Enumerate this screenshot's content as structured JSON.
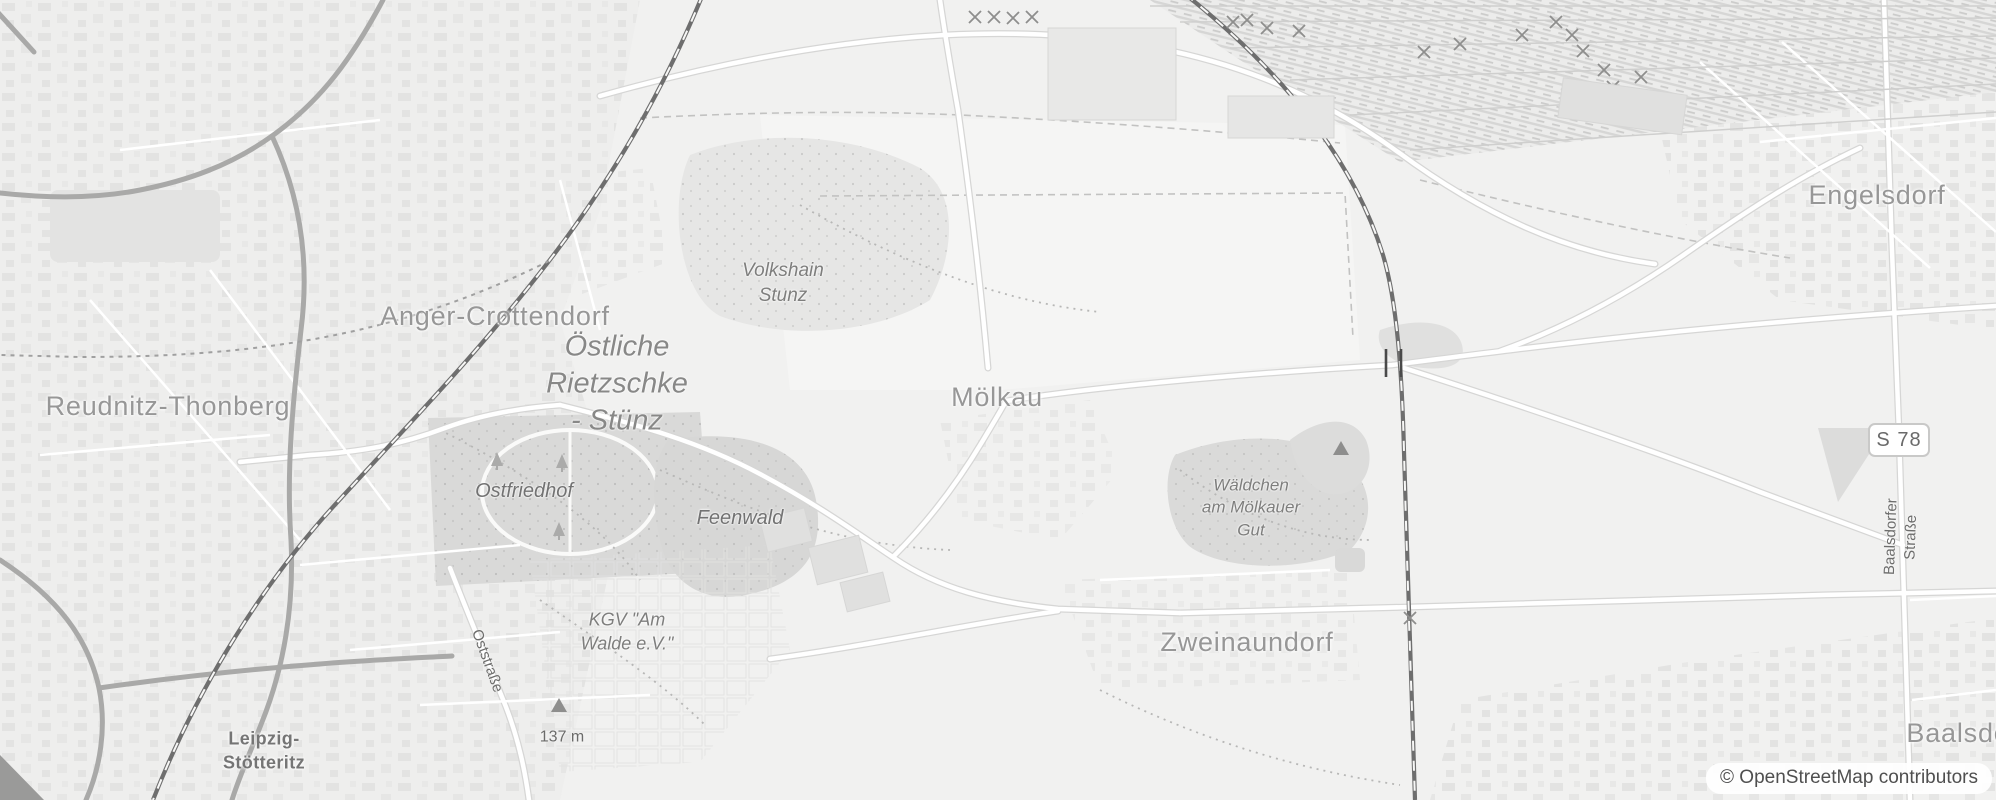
{
  "attribution": {
    "text": "© OpenStreetMap contributors"
  },
  "road_shield": {
    "ref": "S 78"
  },
  "places": {
    "engelsdorf": "Engelsdorf",
    "anger_crottendorf": "Anger-Crottendorf",
    "reudnitz_thonberg": "Reudnitz-Thonberg",
    "moelkau": "Mölkau",
    "zweinaundorf": "Zweinaundorf",
    "baalsdorf_clipped": "Baalsdo",
    "leipzig_stoetteritz": "Leipzig-\nStötteritz"
  },
  "nature_labels": {
    "oestliche_rietzschke_stuenz": "Östliche\nRietzschke\n- Stünz",
    "volkshain_stunz": "Volkshain\nStunz",
    "ostfriedhof": "Ostfriedhof",
    "feenwald": "Feenwald",
    "kgv_am_walde": "KGV \"Am\nWalde e.V.\"",
    "waeldchen_am_moelkauer_gut": "Wäldchen\nam Mölkauer\nGut"
  },
  "street_labels": {
    "oststrasse": "Oststraße",
    "baalsdorfer_strasse": "Baalsdorfer Straße"
  },
  "elevation_label": {
    "value": "137 m"
  },
  "colors": {
    "background": "#f1f1f0",
    "urban_block": "#e3e3e2",
    "wood": "#d8d8d7",
    "cemetery": "#d9d9d8",
    "field": "#f5f5f4",
    "road_fill": "#ffffff",
    "road_casing": "#d6d6d5",
    "major_road": "#a9a9a8",
    "railway": "#6e6e6e",
    "place_label": "#979797",
    "nature_label": "#7e7e7d",
    "attribution_text": "#4f4f4f"
  }
}
